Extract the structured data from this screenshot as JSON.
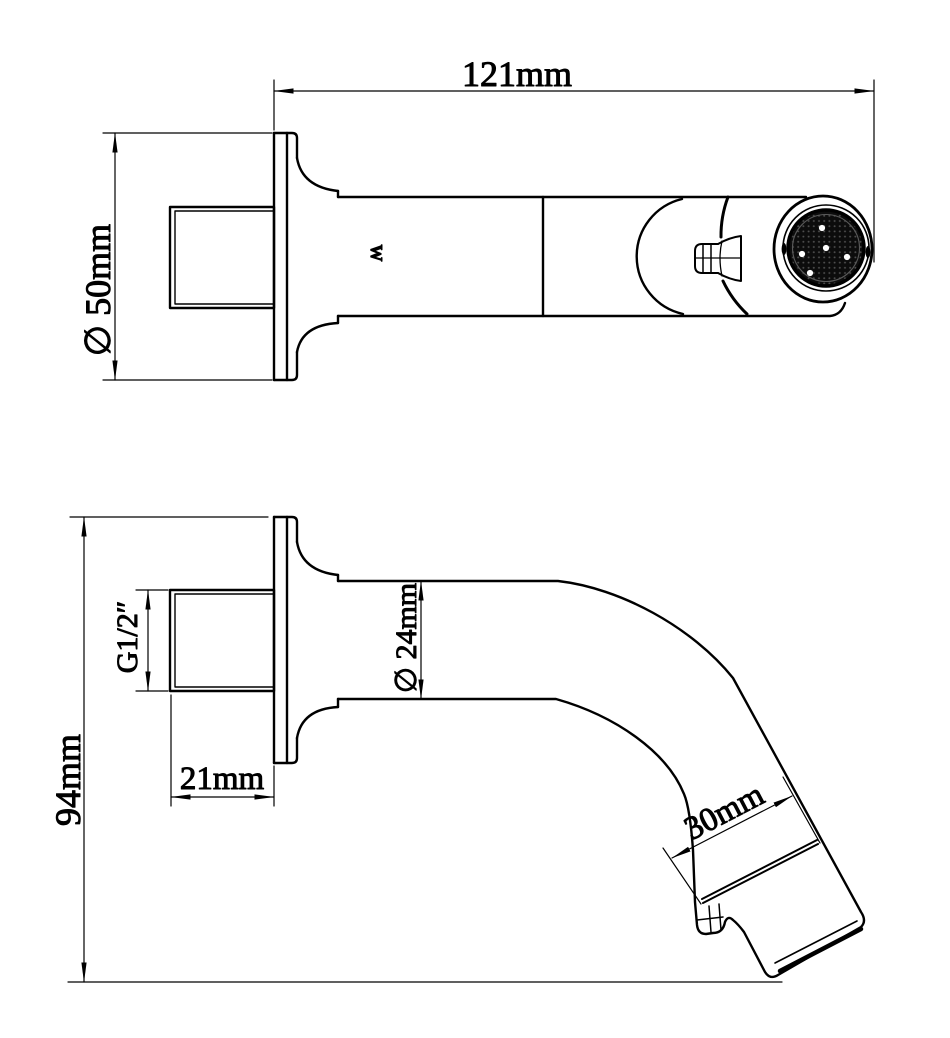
{
  "page": {
    "background": "#ffffff",
    "line_color": "#000000",
    "kind": "technical drawing, two orthographic views of a wall-mount spout"
  },
  "top_view": {
    "dim_length": "121mm",
    "dim_flange": "∅ 50mm",
    "marking": "W"
  },
  "side_view": {
    "dim_height": "94mm",
    "dim_thread": "G1/2″",
    "dim_thread_len": "21mm",
    "dim_tube": "∅ 24mm",
    "dim_tip": "30mm"
  }
}
